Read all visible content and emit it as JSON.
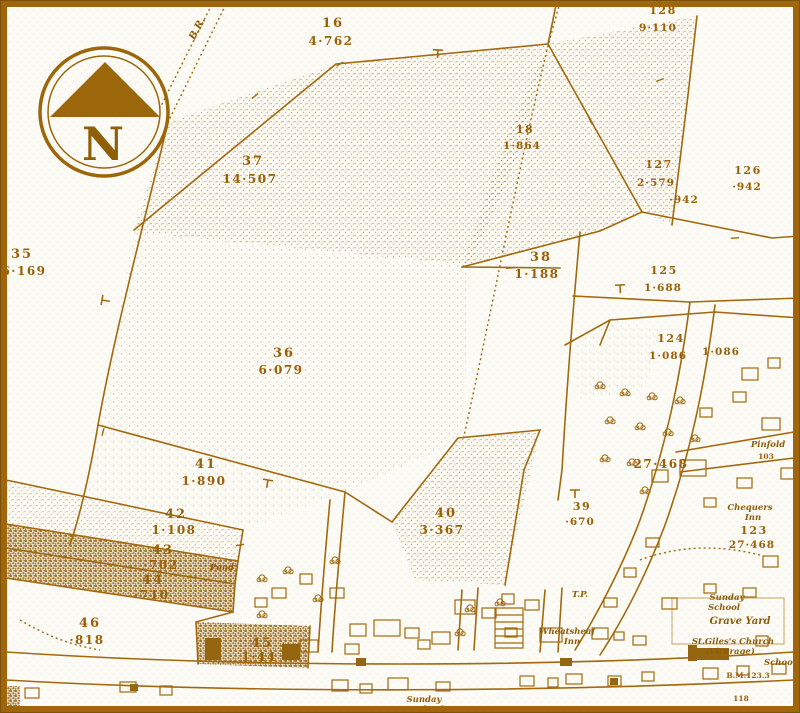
{
  "map": {
    "compass_letter": "N",
    "railway_label": "B.R.",
    "parcels": [
      {
        "number": "16",
        "area": "4·762"
      },
      {
        "number": "128",
        "area": "9·110"
      },
      {
        "number": "37",
        "area": "14·507"
      },
      {
        "number": "18",
        "area": "1·864"
      },
      {
        "number": "127",
        "area": "2·579"
      },
      {
        "number": "126",
        "area": "·942"
      },
      {
        "number": "35",
        "area": "6·169"
      },
      {
        "number": "38",
        "area": "1·188"
      },
      {
        "number": "125",
        "area": "1·688"
      },
      {
        "number": "124",
        "area": "1·086"
      },
      {
        "number": "36",
        "area": "6·079"
      },
      {
        "number": "41",
        "area": "1·890"
      },
      {
        "number": "42",
        "area": "1·108"
      },
      {
        "number": "43",
        "area": "·702"
      },
      {
        "number": "44",
        "area": "·710"
      },
      {
        "number": "40",
        "area": "3·367"
      },
      {
        "number": "39",
        "area": "·670"
      },
      {
        "number": "46",
        "area": "·818"
      },
      {
        "number": "45",
        "area": "1·44"
      },
      {
        "number": "123",
        "area": "27·468"
      }
    ],
    "stray_values": {
      "area942": "·942",
      "area1086": "1·086",
      "area27468": "27·468",
      "pinfold_number": "103",
      "benchmark": "B.M.123.3",
      "v118": "118"
    },
    "places": {
      "pond": "Pond",
      "tp": "T.P.",
      "wheatsheaf_line1": "Wheatsheaf",
      "wheatsheaf_line2": "Inn",
      "chequers_line1": "Chequers",
      "chequers_line2": "Inn",
      "pinfold": "Pinfold",
      "sunday_school_line1": "Sunday",
      "sunday_school_line2": "School",
      "grave_yard": "Grave Yard",
      "church_line1": "St.Giles's Church",
      "church_line2": "(Vicarage)",
      "school": "School",
      "bottom_sunday_line1": "Sunday",
      "bottom_sunday_line2": "School"
    },
    "colors": {
      "line": "#a2690f",
      "text": "#9a6008",
      "frame": "#a1660b",
      "paper": "#fcfbf5"
    }
  }
}
